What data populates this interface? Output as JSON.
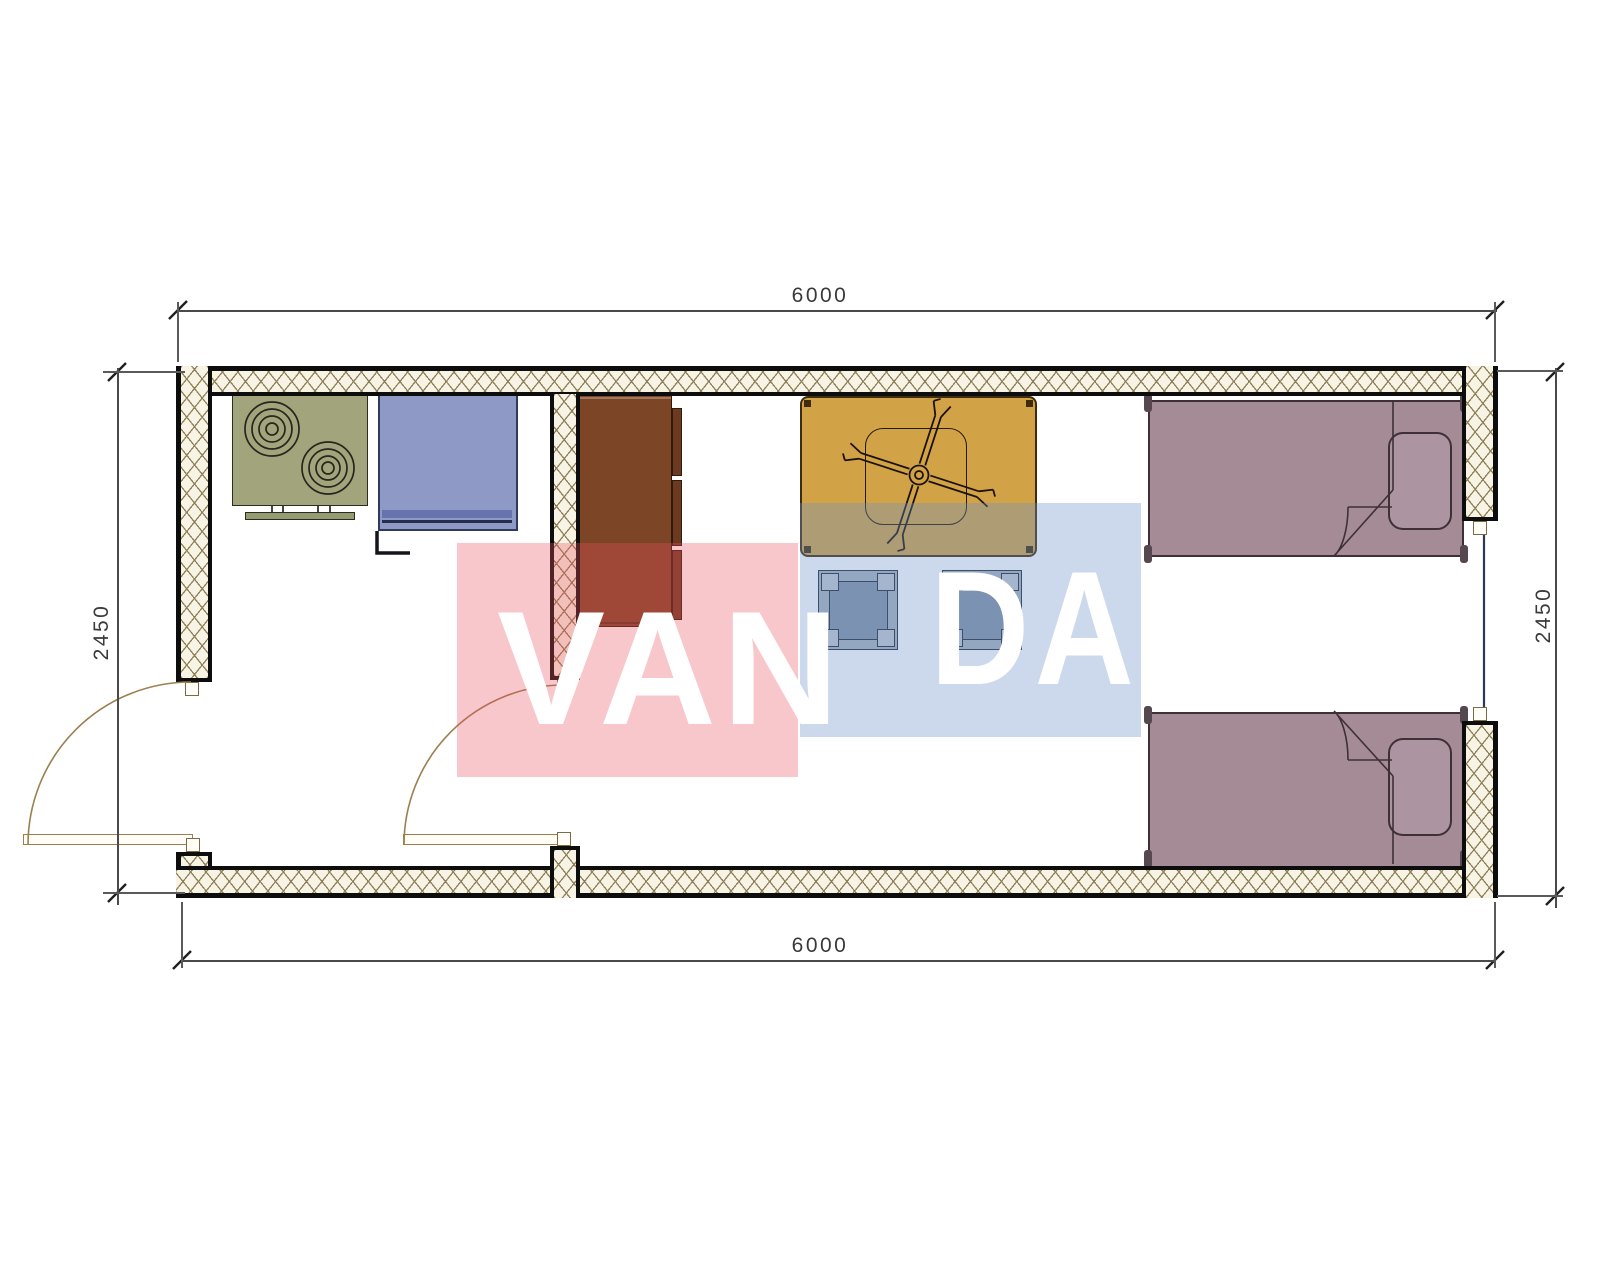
{
  "dimensions": {
    "top": "6000",
    "bottom": "6000",
    "left": "2450",
    "right": "2450"
  },
  "watermark": {
    "text_left": "VAN",
    "text_right": "DA"
  },
  "colors": {
    "wall_hatch_bg": "#f7f3e5",
    "wall_hatch_line": "#8d7f58",
    "wall_edge": "#0d0d0d",
    "stove_green": "#a2a57c",
    "appliance_blue": "#8e99c6",
    "cabinet_brown": "#7c4526",
    "table_orange": "#d2a247",
    "stool_gray": "#8492a8",
    "bed_mauve": "#a48b96",
    "door_arc": "#9b7f4e",
    "window_line": "#2c3a55",
    "dimension_text": "#3a3a3a",
    "watermark_pink": "rgba(232,80,95,0.32)",
    "watermark_blue": "rgba(110,145,200,0.35)"
  }
}
